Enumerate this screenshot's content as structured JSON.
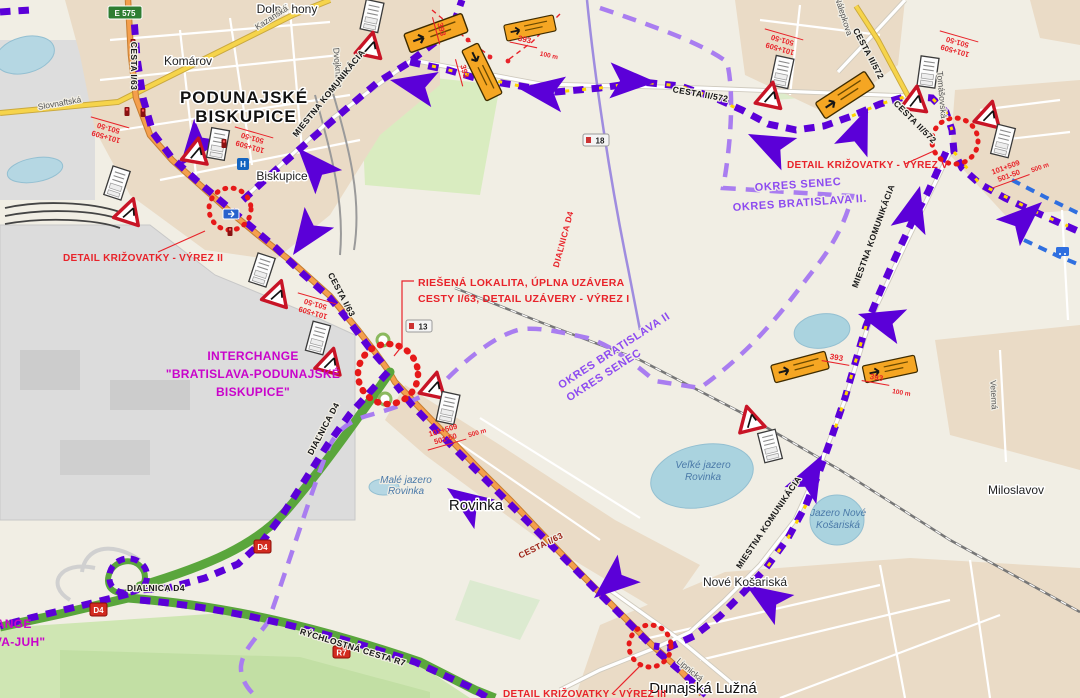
{
  "map": {
    "places": {
      "dolne_hony": "Dolné hony",
      "komarov": "Komárov",
      "pb1": "PODUNAJSKÉ",
      "pb2": "BISKUPICE",
      "biskupice": "Biskupice",
      "rovinka": "Rovinka",
      "miloslavov": "Miloslavov",
      "dunajska_luzna": "Dunajská Lužná",
      "nove_kosariska": "Nové Košariská"
    },
    "streets": {
      "slovnaftska": "Slovnaftská",
      "kazanska": "Kazanská",
      "dvojkrizna": "Dvojkrížna",
      "nalepkova": "Nálepkova",
      "tomasovska": "Tomášovská",
      "lipnicka": "Lipnická",
      "veterna": "Veterná"
    },
    "roads": {
      "cesta_i63": "CESTA I/63",
      "cesta_ii572": "CESTA II/572",
      "miestna": "MIESTNA KOMUNIKÁCIA",
      "dialnica_d4": "DIAĽNICA D4",
      "rychlostna_r7": "RÝCHLOSTNÁ CESTA R7"
    },
    "lakes": {
      "male1": "Malé jazero",
      "male2": "Rovinka",
      "velke1": "Veľké jazero",
      "velke2": "Rovinka",
      "nove1": "Jazero Nové",
      "nove2": "Košariská"
    },
    "shields": {
      "e575": "E 575",
      "n18": "18",
      "n13": "13",
      "d4": "D4",
      "r7": "R7"
    },
    "icons": {
      "hospital": "H"
    }
  },
  "ann": {
    "detail_vyrez_ii": "DETAIL KRIŽOVATKY - VÝREZ II",
    "detail_vyrez_v": "DETAIL KRIŽOVATKY - VÝREZ V",
    "detail_vyrez_iii": "DETAIL KRIŽOVATKY - VÝREZ III",
    "riesena_line1": "RIEŠENÁ LOKALITA, ÚPLNA UZÁVERA",
    "riesena_line2": "CESTY I/63, DETAIL UZÁVERY - VÝREZ I",
    "interchange_pb_line1": "INTERCHANGE",
    "interchange_pb_line2": "\"BRATISLAVA-PODUNAJSKÉ",
    "interchange_pb_line3": "BISKUPICE\"",
    "interchange_juh_line1": "INTERCHANGE",
    "interchange_juh_line2": "\"BRATISLAVA-JUH\"",
    "okres_senec_h": "OKRES SENEC",
    "okres_ba2_h": "OKRES BRATISLAVA II.",
    "okres_ba2_diag": "OKRES BRATISLAVA II",
    "okres_senec_diag": "OKRES SENEC",
    "dialnica_d4_red": "DIAĽNICA D4",
    "chainage_top": "101+509",
    "chainage_bottom": "501-50",
    "dim_393": "393",
    "dim_100m": "100 m",
    "dim_500m": "500 m"
  },
  "colors": {
    "route_purple": "#5b00d8",
    "boundary_purple": "#a97df0",
    "route_yellow": "#ffd400",
    "annotation_red": "#e8232a",
    "interchange_magenta": "#c903cb",
    "okres_purple": "#8d4bf0",
    "motorway_green": "#5aa63c",
    "transit_blue": "#2f6fe0",
    "closure_red": "#e61919"
  }
}
